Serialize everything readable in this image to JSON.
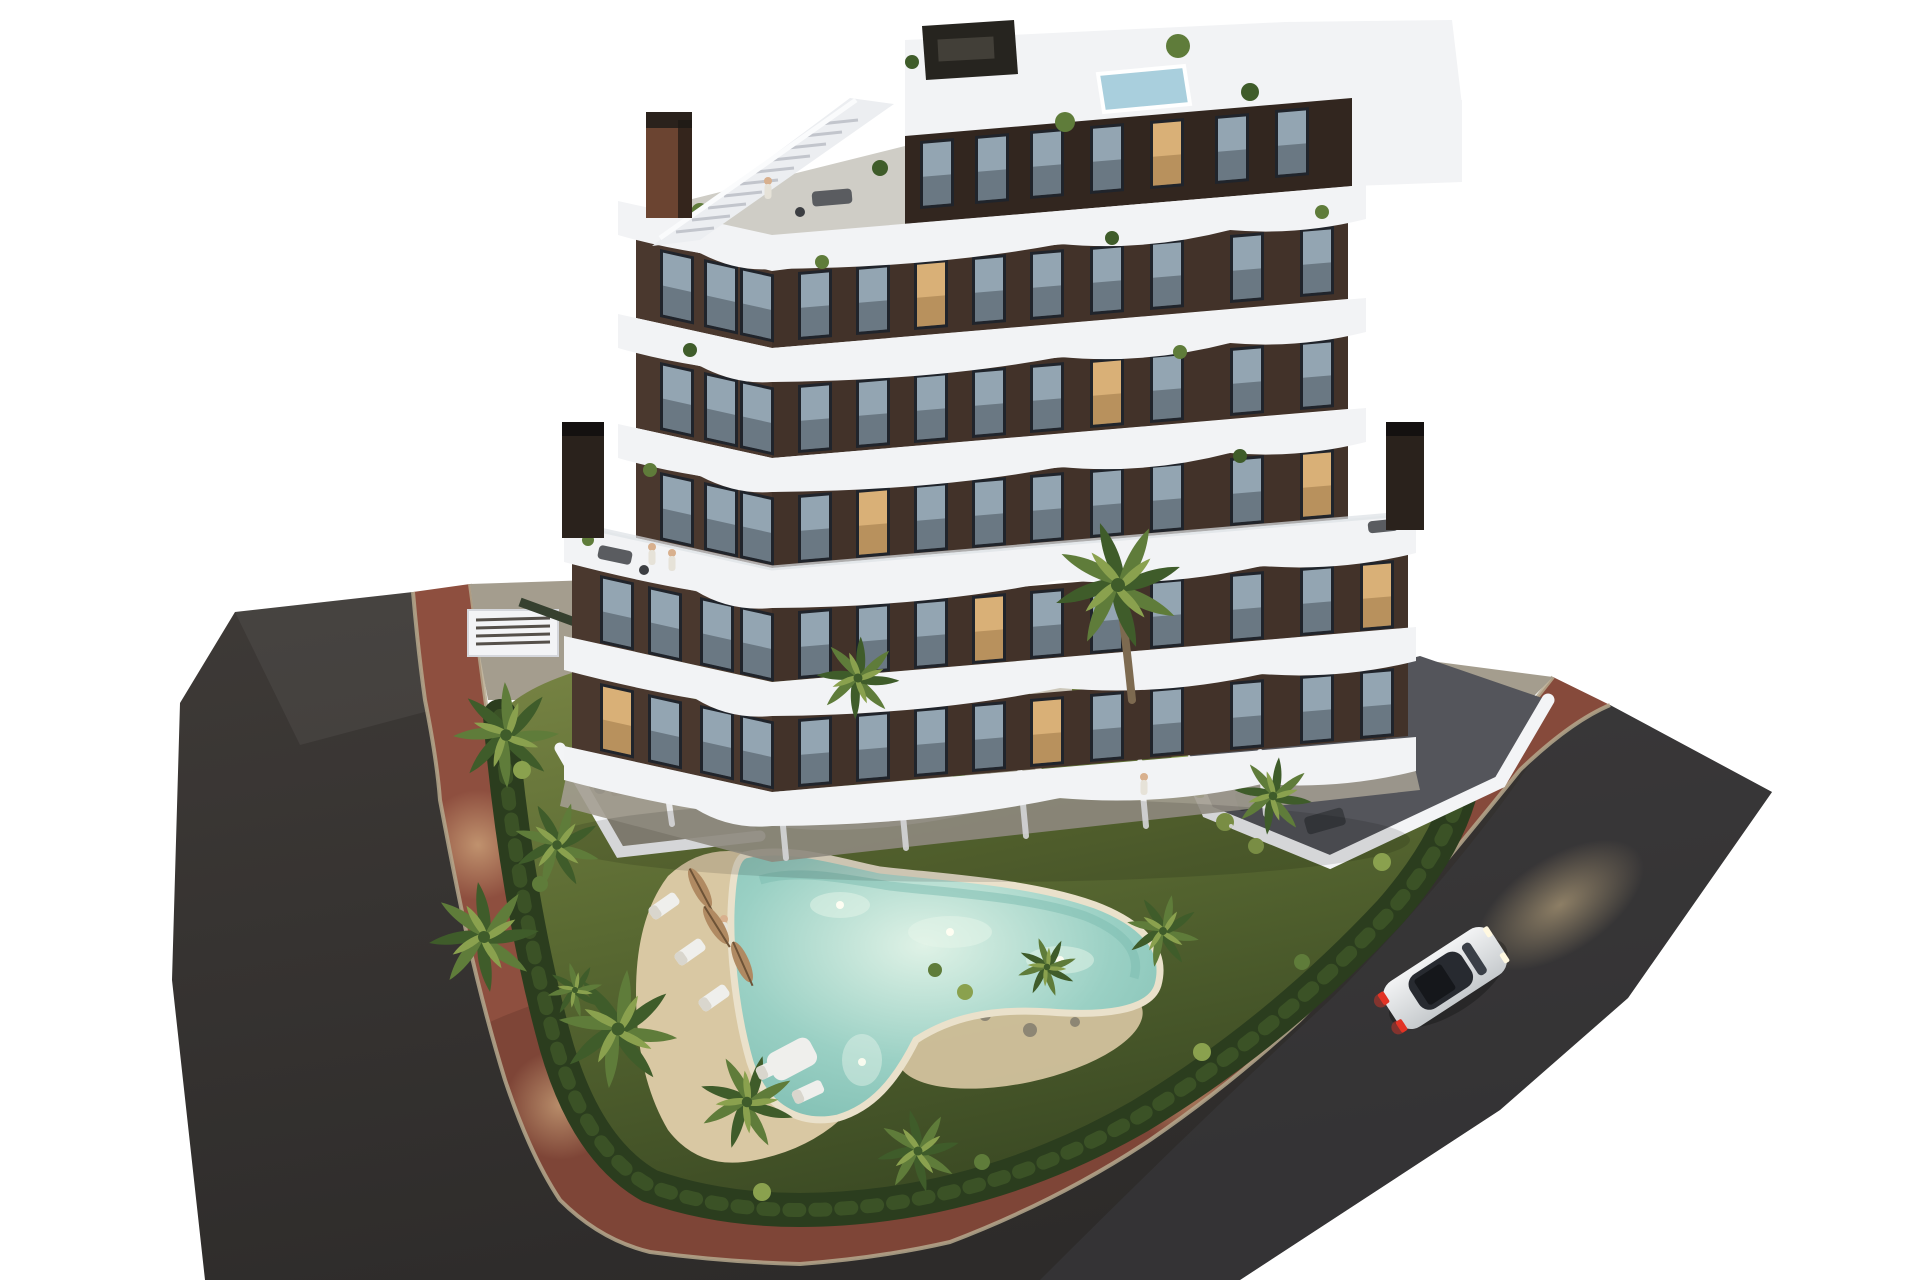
{
  "scene": {
    "type": "3d-architectural-render",
    "subject": "aerial dusk view of a modern apartment block with curved white balconies, rooftop pool, landscaped garden, freeform swimming pool, palm trees, red sidewalk loop, asphalt roads and a white car",
    "background": "#ffffff"
  },
  "building": {
    "floors_visible": 7,
    "facade_style": "dark brown panels with curved white balcony bands and glass railings",
    "rooftop": {
      "has_pool": true,
      "has_stairs": true,
      "has_pergola": true,
      "chimneys": 3
    },
    "ground_floor": {
      "private_patios": true,
      "garage_vent": true
    }
  },
  "site": {
    "garden": {
      "lawn": true,
      "hedge_border": true,
      "island_planter": true,
      "palm_trees_approx": 10,
      "shrub_clusters": true
    },
    "pool": {
      "shape": "freeform-boomerang",
      "underwater_lights": 4,
      "sand_deck": true,
      "umbrellas": 3,
      "loungers": 5,
      "lounge_seat": true
    },
    "terraces": {
      "right_tiled_terrace": true,
      "left_patio": true,
      "dining_sets": 2
    },
    "roads": {
      "asphalt_loop": true,
      "red_sidewalk_loop": true,
      "path_lamps": 3
    },
    "vehicles": [
      {
        "type": "car",
        "color_name": "white",
        "headlights_on": true,
        "taillights_on": true
      }
    ],
    "people_visible_approx": 8
  },
  "colors": {
    "background": "#ffffff",
    "asphalt": "#3e3a37",
    "asphalt_dark": "#2d2b2a",
    "asphalt_cool": "#3a3b3e",
    "sidewalk": "#8e4f3f",
    "sidewalk_dark": "#6e3c30",
    "curb": "#b5a88d",
    "concrete": "#a49d8e",
    "terrace_tile": "#54555b",
    "wall_white": "#f3f4f6",
    "wall_shadow": "#d5d7dc",
    "lawn_light": "#7b8746",
    "lawn": "#5a6a32",
    "lawn_dark": "#3c4b24",
    "hedge": "#2b3d1e",
    "hedge_light": "#4c682e",
    "sand": "#d9c8a3",
    "sand_dark": "#bfa87f",
    "pool_water": "#9ad0c4",
    "pool_deep": "#7cbcb0",
    "pool_glow": "#dff2e6",
    "pool_rim": "#eae1cb",
    "roof_pool": "#a9cfdd",
    "facade": "#4a382e",
    "facade_dark": "#32261f",
    "slab_white": "#f2f3f5",
    "slab_shadow": "#c9ccd3",
    "window_frame": "#20242b",
    "window_glass": "#93a5b2",
    "window_warm": "#d9b077",
    "palm_dark": "#3f5c2a",
    "palm_mid": "#5f7c3a",
    "palm_light": "#8aa14e",
    "trunk": "#7d6a50",
    "pergola": "#26241f",
    "chimney": "#2a221c",
    "chimney_rust": "#6b4431",
    "car_body_light": "#f2f3f4",
    "car_body_dark": "#c6cacd",
    "car_glass": "#272a30",
    "taillight": "#e23325",
    "light_warm": "#f0d29b",
    "umbrella": "#b08a62",
    "skin": "#d8b08e"
  }
}
